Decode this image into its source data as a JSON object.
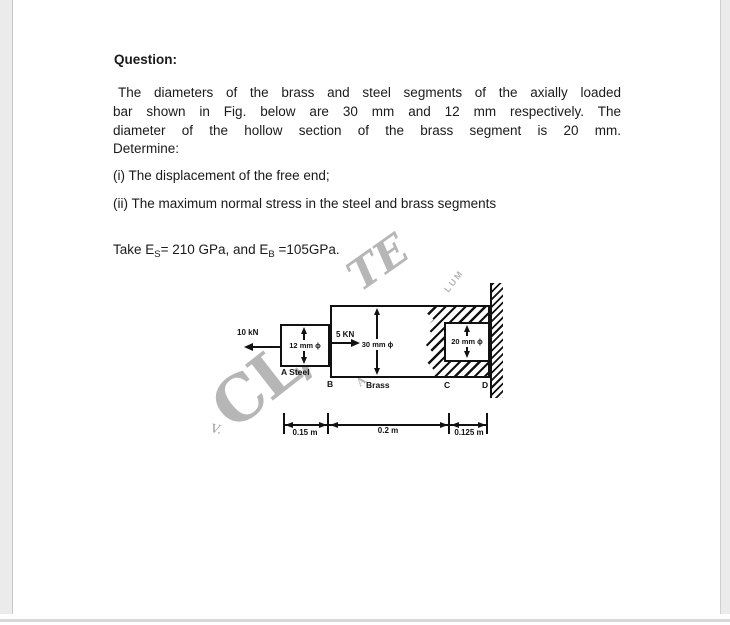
{
  "document": {
    "heading": "Question:",
    "paragraph_lines": [
      "The diameters of the brass and steel segments of the axially loaded",
      "bar shown in Fig. below are 30 mm and 12 mm respectively. The",
      "diameter of the hollow section of the brass segment is 20 mm.",
      "Determine:"
    ],
    "items": [
      "(i) The displacement of the free end;",
      "(ii) The maximum normal stress in the steel and brass segments"
    ],
    "materials": {
      "prefix": "Take E",
      "sub1": "S",
      "mid": "= 210 GPa, and E",
      "sub2": "B",
      "suffix": " =105GPa."
    }
  },
  "figure": {
    "forces": {
      "left": "10 kN",
      "mid": "5 KN"
    },
    "diameters": {
      "steel": "12 mm ϕ",
      "brass": "30 mm ϕ",
      "hollow": "20 mm ϕ"
    },
    "labels": {
      "a": "A Steel",
      "b": "B",
      "brass": "Brass",
      "c": "C",
      "d": "D"
    },
    "dimensions": {
      "seg1": "0.15 m",
      "seg2": "0.2 m",
      "seg3": "0.125 m"
    },
    "watermark": {
      "main": "CL/",
      "top": "TE",
      "small": "LUM",
      "mid": "A",
      "mark": "V."
    }
  },
  "colors": {
    "ink": "#111111",
    "text": "#1a1a1a",
    "watermark": "#b6b6b6",
    "margin": "#ebebeb"
  }
}
